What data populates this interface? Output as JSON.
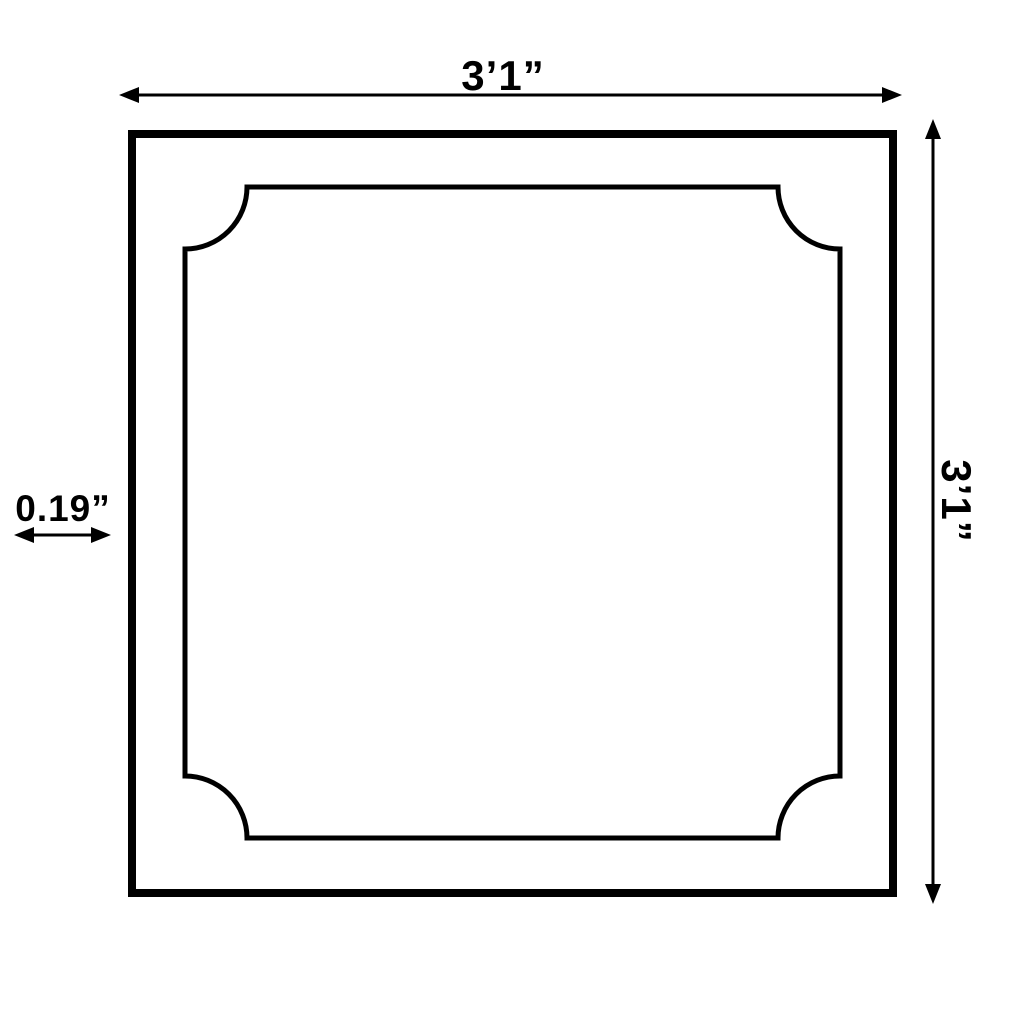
{
  "diagram": {
    "type": "dimension-drawing",
    "subject": "square panel moulding with concave notched corners",
    "colors": {
      "line": "#000000",
      "background": "#ffffff"
    },
    "dimensions": {
      "width_label": "3’1”",
      "height_label": "3’1”",
      "offset_label": "0.19”"
    }
  }
}
